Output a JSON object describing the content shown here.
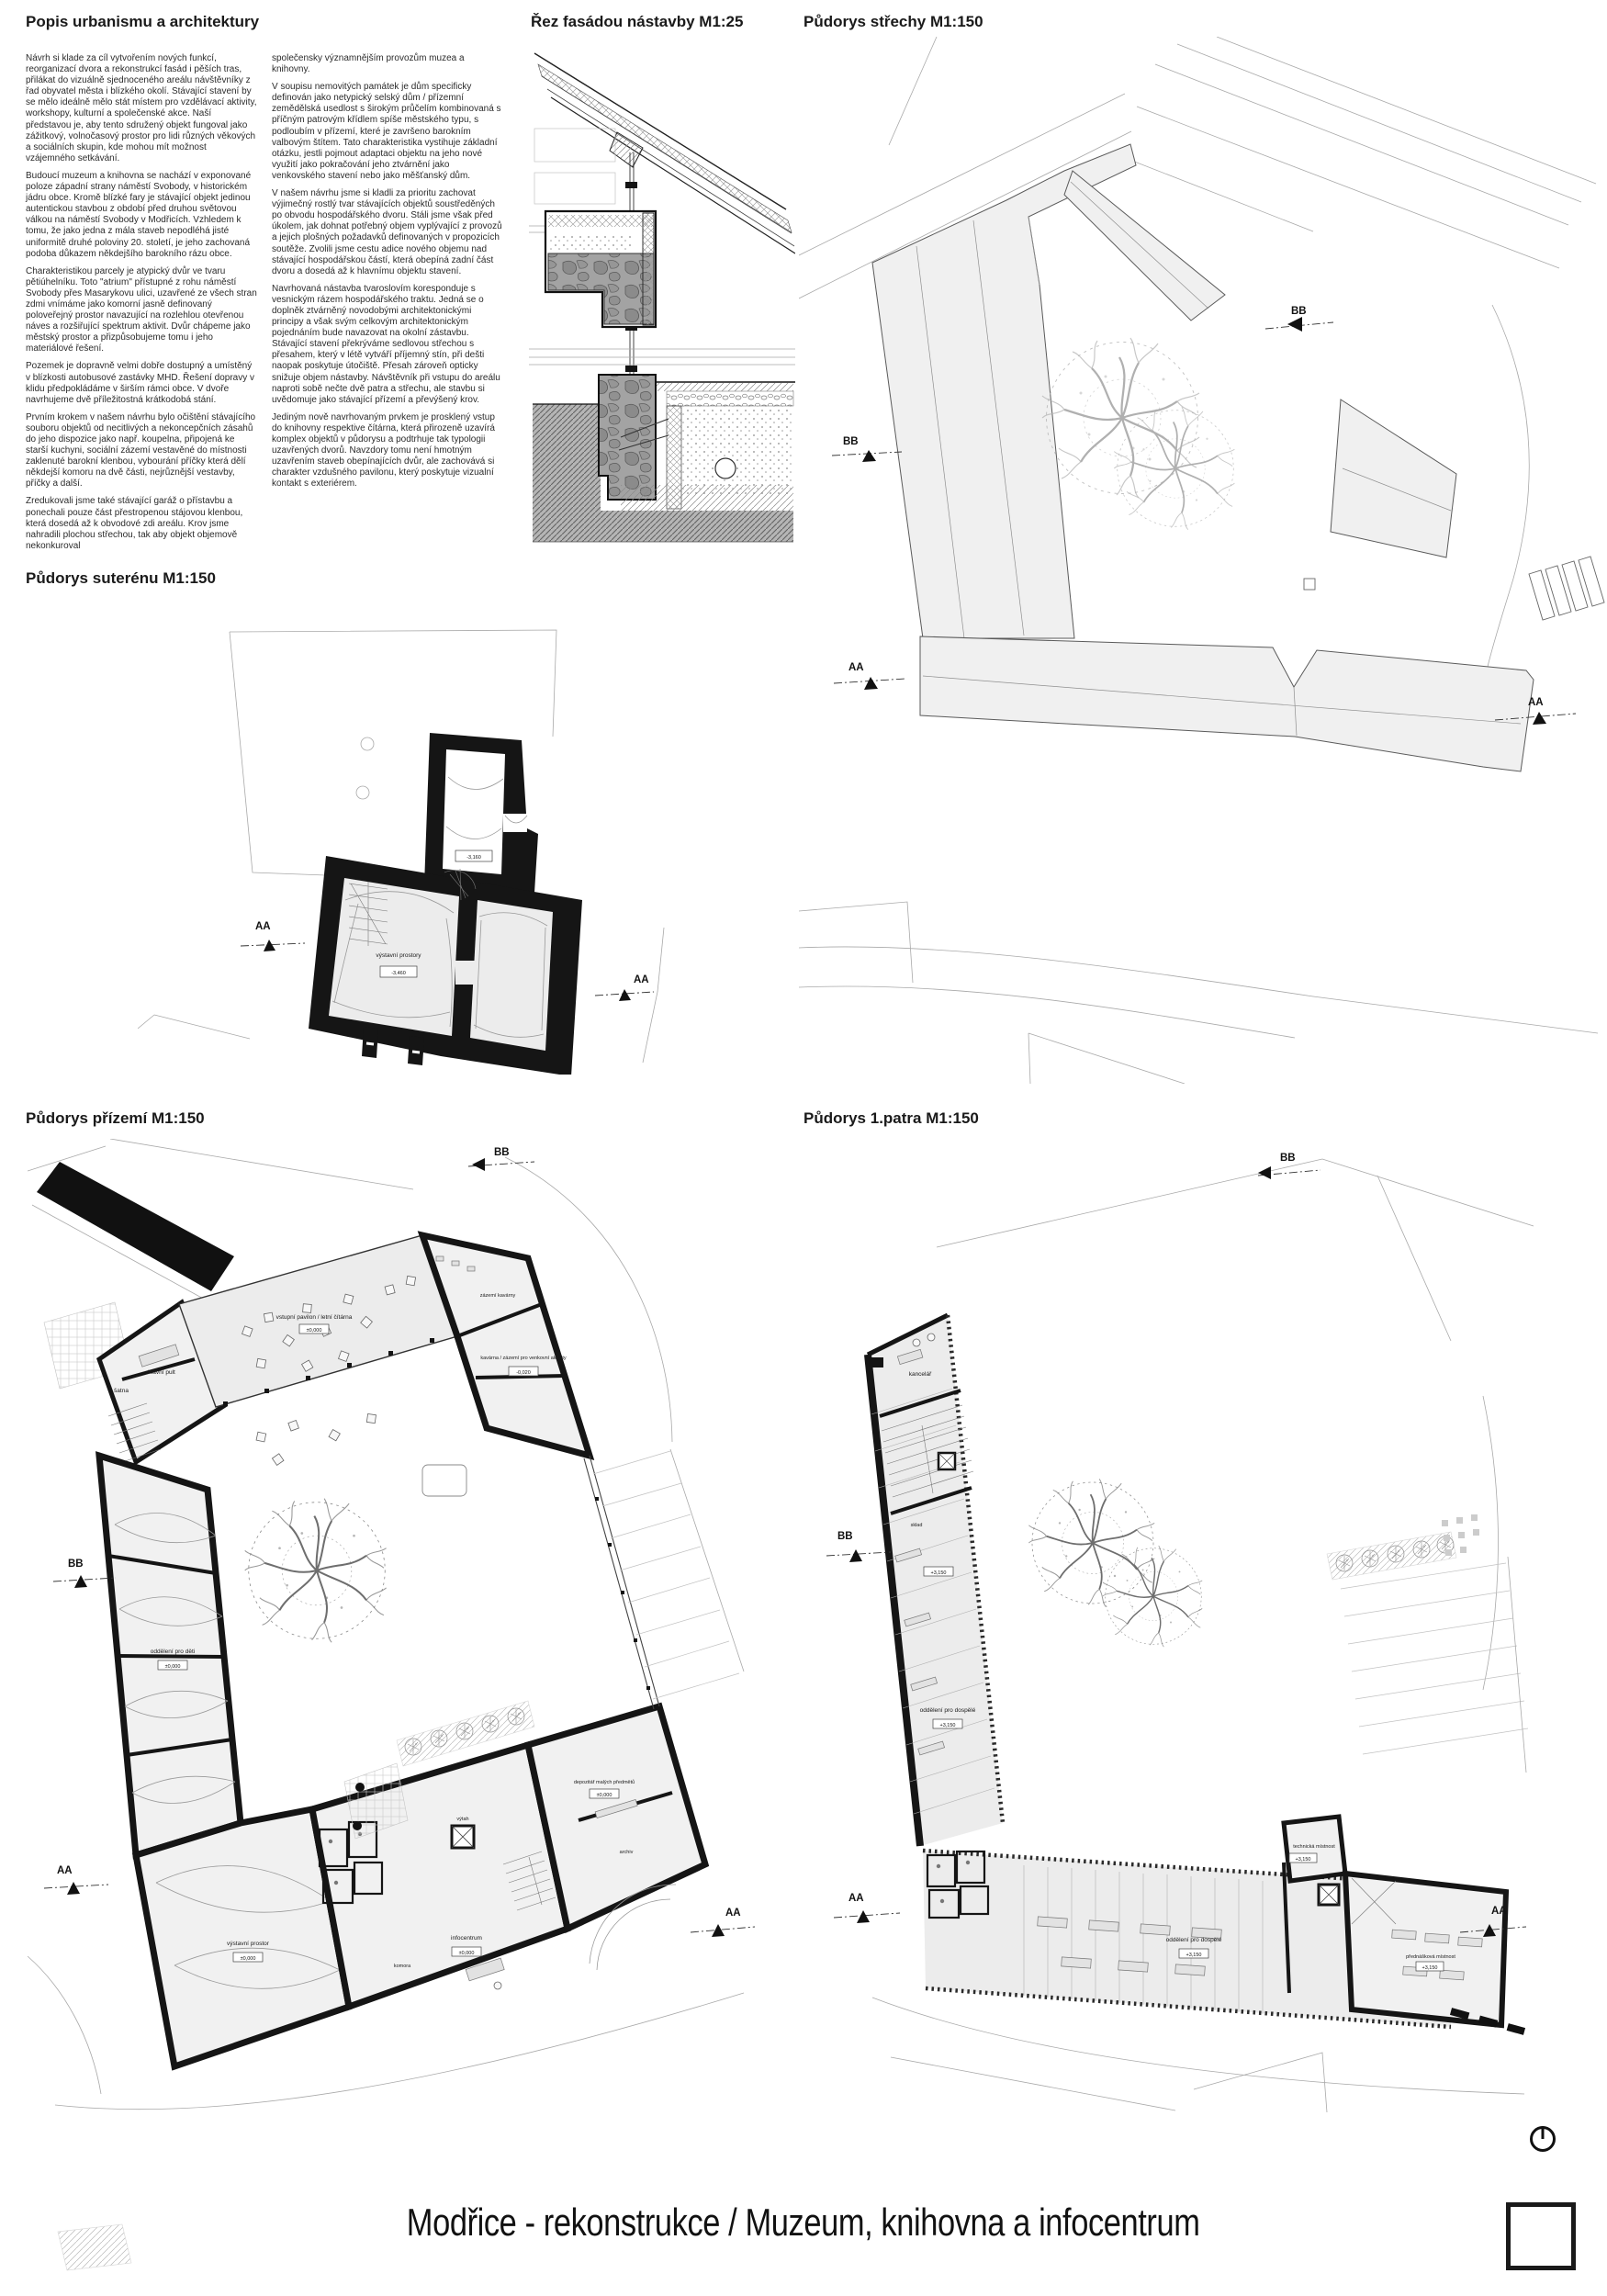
{
  "sheet": {
    "title": "Modřice - rekonstrukce / Muzeum, knihovna a infocentrum",
    "accent_color": "#1a1a1a",
    "paper_color": "#ffffff"
  },
  "description": {
    "heading": "Popis urbanismu a architektury",
    "column1": [
      "Návrh si klade za cíl vytvořením nových funkcí, reorganizací dvora a rekonstrukcí fasád i pěších tras, přilákat do vizuálně sjednoceného areálu návštěvníky z řad obyvatel města i blízkého okolí. Stávající stavení by se mělo ideálně mělo stát místem pro vzdělávací aktivity, workshopy, kulturní a společenské akce. Naší představou je, aby tento sdružený objekt fungoval jako zážitkový, volnočasový prostor pro lidi různých věkových a sociálních skupin, kde mohou mít možnost vzájemného setkávání.",
      "Budoucí muzeum a knihovna se nachází v exponované poloze západní strany náměstí Svobody, v historickém jádru obce. Kromě blízké fary je stávající objekt jedinou autentickou stavbou z období před druhou světovou válkou na náměstí Svobody v Modřicích. Vzhledem k tomu, že jako jedna z mála staveb nepodléhá jisté uniformitě druhé poloviny 20. století, je jeho zachovaná podoba důkazem někdejšího barokního rázu obce.",
      "Charakteristikou parcely je atypický dvůr ve tvaru pětiúhelníku. Toto \"atrium\" přístupné z rohu náměstí Svobody přes Masarykovu ulici, uzavřené ze všech stran zdmi vnímáme jako komorní jasně definovaný poloveřejný prostor navazující na rozlehlou otevřenou náves a rozšiřující spektrum aktivit. Dvůr chápeme jako městský prostor a přizpůsobujeme tomu i jeho materiálové řešení.",
      "Pozemek je dopravně velmi dobře dostupný a umístěný v blízkosti autobusové zastávky MHD. Řešení dopravy v klidu předpokládáme v širším rámci obce. V dvoře navrhujeme dvě příležitostná krátkodobá stání.",
      "Prvním krokem v našem návrhu bylo očištění stávajícího souboru objektů od necitlivých a nekoncepčních zásahů do jeho dispozice jako např. koupelna, připojená ke starší kuchyni, sociální zázemí vestavěné do místnosti zaklenuté barokní klenbou, vybourání příčky která dělí někdejší komoru na dvě části, nejrůznější vestavby, příčky a další.",
      "Zredukovali jsme také stávající garáž o přístavbu a ponechali pouze část přestropenou stájovou klenbou, která dosedá až k obvodové zdi areálu. Krov jsme nahradili plochou střechou, tak aby objekt objemově nekonkuroval"
    ],
    "column2": [
      "společensky významnějším provozům muzea a knihovny.",
      "V soupisu nemovitých památek je dům specificky definován jako netypický selský dům / přízemní zemědělská usedlost s širokým průčelím kombinovaná s příčným patrovým křídlem spíše městského typu, s podloubím v přízemí, které je završeno barokním valbovým štítem. Tato charakteristika vystihuje základní otázku, jestli pojmout adaptaci objektu na jeho nové využití jako pokračování jeho ztvárnění jako venkovského stavení nebo jako měšťanský dům.",
      "V našem návrhu jsme si kladli za prioritu zachovat výjimečný rostlý tvar stávajících objektů soustředěných po obvodu hospodářského dvoru. Stáli jsme však před úkolem, jak dohnat potřebný objem vyplývající z provozů a jejich plošných požadavků definovaných v propozicích soutěže. Zvolili jsme cestu adice nového objemu nad stávající hospodářskou částí, která obepíná zadní část dvoru a dosedá až k hlavnímu objektu stavení.",
      "Navrhovaná nástavba tvaroslovím koresponduje s vesnickým rázem hospodářského traktu. Jedná se o doplněk ztvárněný novodobými architektonickými principy a však svým celkovým architektonickým pojednáním bude navazovat na okolní zástavbu. Stávající stavení překrýváme sedlovou střechou s přesahem, který v létě vytváří příjemný stín, při dešti naopak poskytuje útočiště. Přesah zároveň opticky snižuje objem nástavby. Návštěvník při vstupu do areálu naproti sobě nečte dvě patra a střechu, ale stavbu si uvědomuje jako stávající přízemí a převýšený krov.",
      "Jediným nově navrhovaným prvkem je prosklený vstup do knihovny respektive čítárna, která přirozeně uzavírá komplex objektů v půdorysu a podtrhuje tak typologii uzavřených dvorů. Navzdory tomu není hmotným uzavřením staveb obepínajících dvůr, ale zachovává si charakter vzdušného pavilonu, který poskytuje vizualní kontakt s exteriérem."
    ]
  },
  "sections": {
    "facade": {
      "title": "Řez fasádou nástavby M1:25"
    },
    "roof": {
      "title": "Půdorys střechy M1:150",
      "markers": {
        "aa": "AA",
        "bb": "BB"
      }
    },
    "basement": {
      "title": "Půdorys suterénu M1:150",
      "rooms": [
        "výstavní prostory"
      ],
      "levels": [
        "-3,160",
        "-3,460"
      ],
      "markers": {
        "aa": "AA"
      }
    },
    "ground": {
      "title": "Půdorys přízemí M1:150",
      "rooms": [
        "šatna",
        "hlavní pult",
        "vstupní pavilon / letní čítárna",
        "příruční sklad",
        "zázemí kavárny",
        "kavárna / zázemí pro venkovní aktivity",
        "oddělení pro děti",
        "výstavní prostor",
        "depozitář malých předmětů",
        "archiv",
        "infocentrum",
        "komora",
        "výtah"
      ],
      "levels": [
        "±0,000",
        "-0,020"
      ],
      "markers": {
        "aa": "AA",
        "bb": "BB"
      }
    },
    "first": {
      "title": "Půdorys 1.patra M1:150",
      "rooms": [
        "kancelář",
        "sklad",
        "oddělení pro dospělé",
        "technická místnost",
        "výtah",
        "přednášková místnost"
      ],
      "levels": [
        "+3,150"
      ],
      "markers": {
        "aa": "AA",
        "bb": "BB"
      }
    }
  },
  "footer": {
    "north_icon": "north-arrow",
    "logo": "empty-square-outline"
  }
}
